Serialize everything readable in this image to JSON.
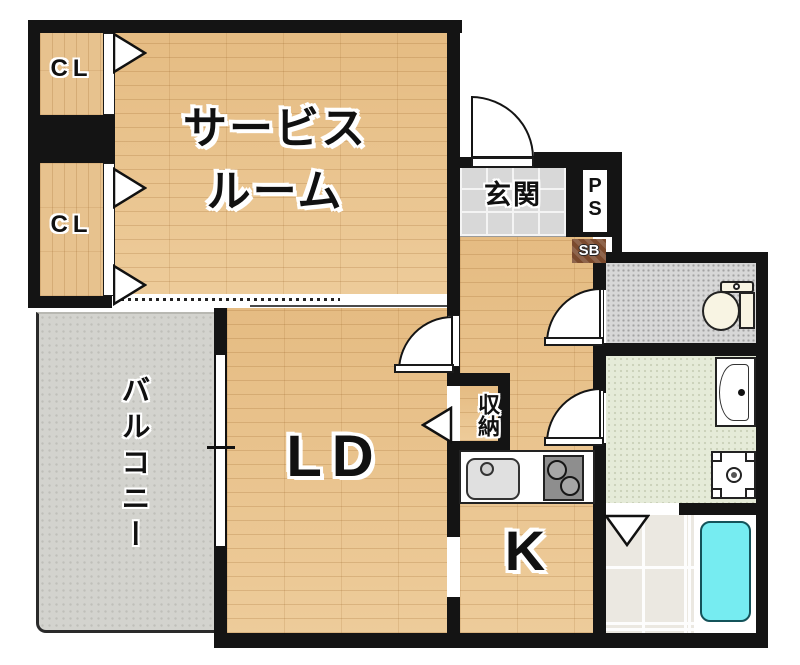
{
  "floorplan": {
    "rooms": {
      "closet_top": {
        "label": "CL"
      },
      "closet_bottom": {
        "label": "CL"
      },
      "service_room": {
        "label_line1": "サービス",
        "label_line2": "ルーム"
      },
      "entrance": {
        "label": "玄関"
      },
      "pipe_space": {
        "label_line1": "P",
        "label_line2": "S"
      },
      "shoe_box": {
        "label": "SB"
      },
      "storage": {
        "label": "収納"
      },
      "living_dining": {
        "label": "LD"
      },
      "kitchen": {
        "label": "K"
      },
      "balcony": {
        "label": "バルコニー"
      }
    },
    "fixtures": [
      "toilet",
      "vanity-sink",
      "washing-machine-pan",
      "bathtub",
      "kitchen-sink",
      "gas-stove"
    ],
    "colors": {
      "wall": "#141414",
      "wood_floor": "#e9c28b",
      "balcony_floor": "#d3d3ce",
      "bathtub": "#76ecf1",
      "washroom_floor": "#e5ebd8",
      "entrance_tile": "#d8d8d8",
      "toilet_floor": "#d7d7d7",
      "shoe_box": "#7b4a2d"
    }
  }
}
